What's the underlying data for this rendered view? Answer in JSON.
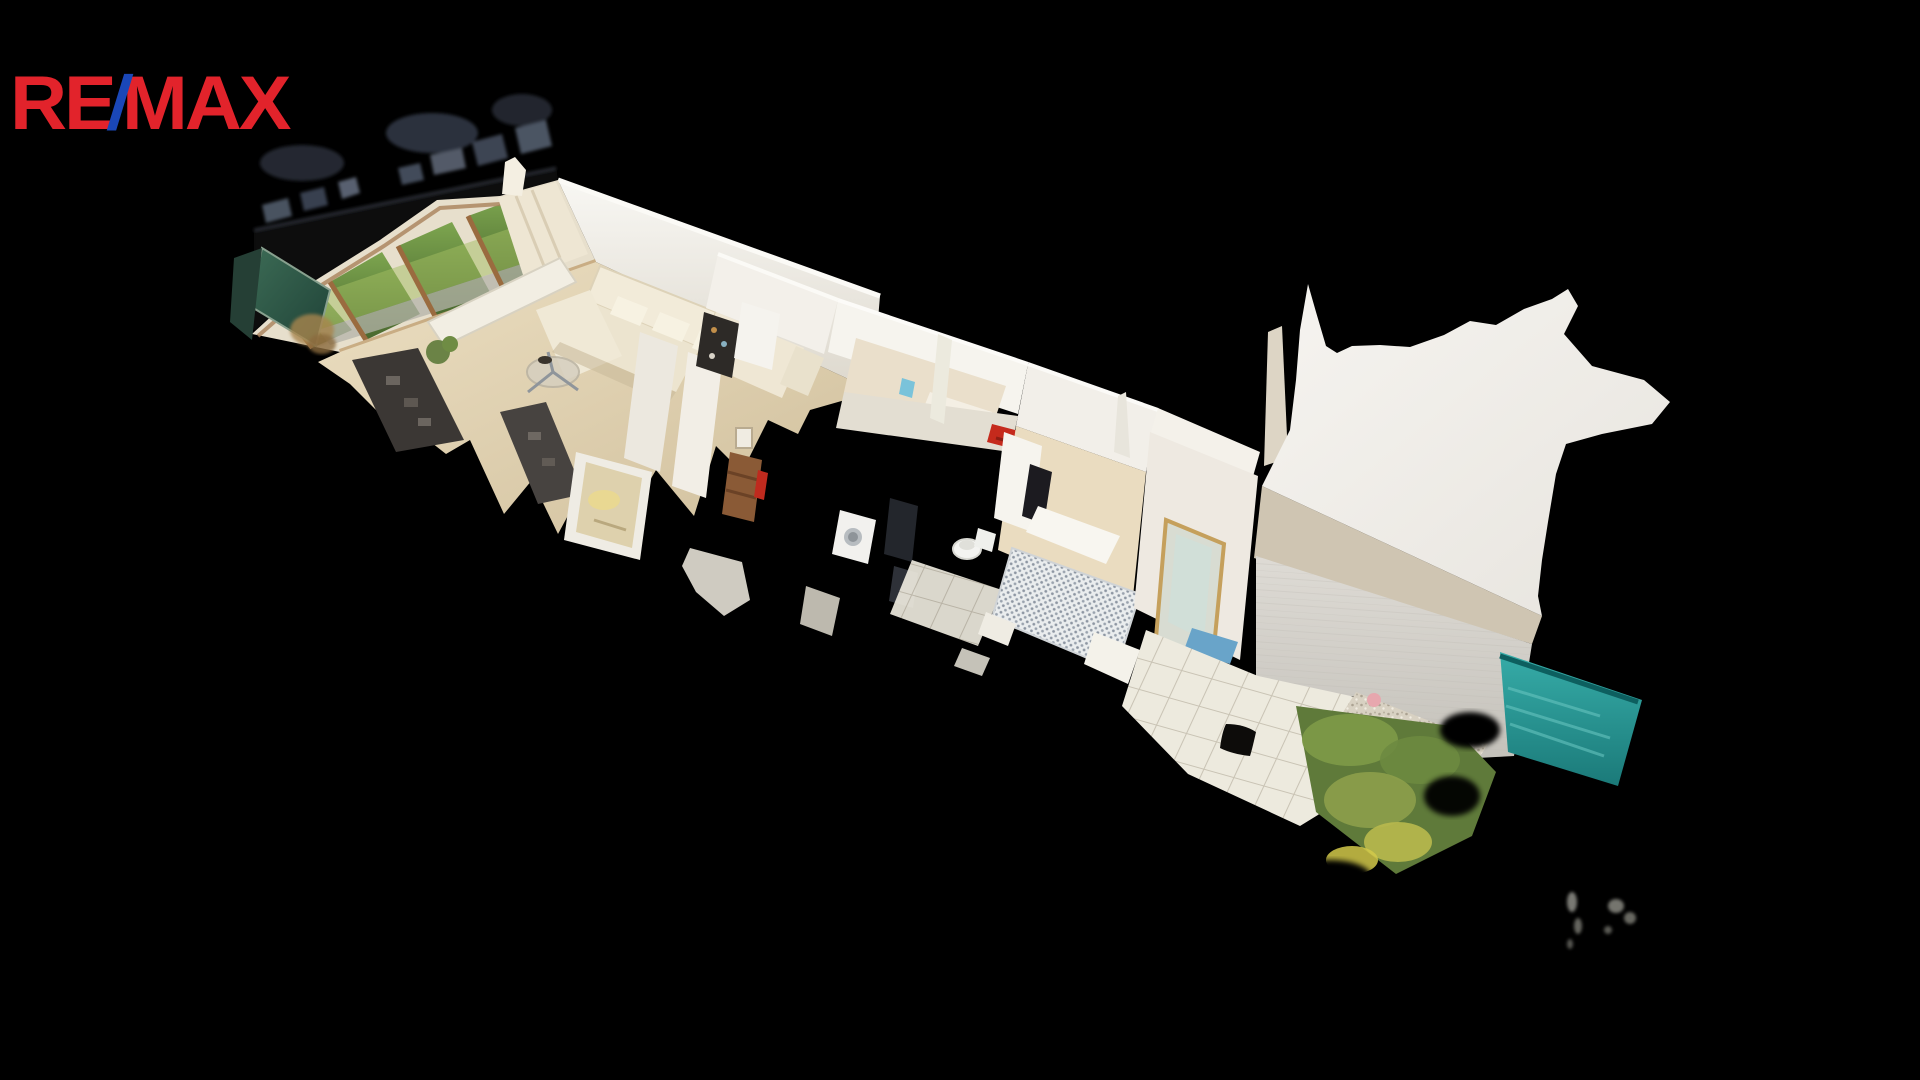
{
  "logo": {
    "re": "RE",
    "slash": "/",
    "max": "MAX",
    "brand_red": "#E2232B",
    "brand_blue": "#1A47B8"
  },
  "scene": {
    "kind": "3D dollhouse cutaway scan of an apartment (virtual tour view)",
    "background_color": "#000000",
    "regions": [
      {
        "name": "living-room",
        "features": "garden windows, cream corner sofa, glass coffee table, curtains, radiator, dark shelving, green glass cabinet"
      },
      {
        "name": "hallway-bathroom",
        "features": "white wall slabs, mirror, wooden dresser, washing machine, toilet, dark heater panel, red towel"
      },
      {
        "name": "bedroom",
        "features": "double bed with grey patterned duvet, white wardrobe, terrace door with gold frame, blue steps"
      },
      {
        "name": "terrace",
        "features": "white floor tiles, dark doormat, gravel border, pink stone, shrubs, teal water strip, grey boundary wall"
      },
      {
        "name": "scan-artifacts",
        "features": "blurred roof-edge debris, floating grey fragments"
      }
    ],
    "palette": {
      "wall_white": "#F3F1EC",
      "wall_shadow": "#E2DDD3",
      "wood_floor": "#E6D8B8",
      "garden_green": "#6B8F3E",
      "lawn_green": "#A3BD62",
      "shrub_green": "#7E9A48",
      "shrub_yellow": "#D2C94A",
      "teal_water": "#2AA09D",
      "tile_white": "#EDEADE",
      "gravel_beige": "#D8D1C2",
      "wall_beige_base": "#CFC5B2",
      "grey_wall": "#D2CFC8",
      "towel_red": "#C52A1C",
      "step_blue": "#69A4C9",
      "curtain_cream": "#EEE6D3",
      "sofa_cream": "#F0E9D6",
      "dark_shelf": "#3B3734",
      "dresser_wood": "#8A5A36"
    }
  }
}
